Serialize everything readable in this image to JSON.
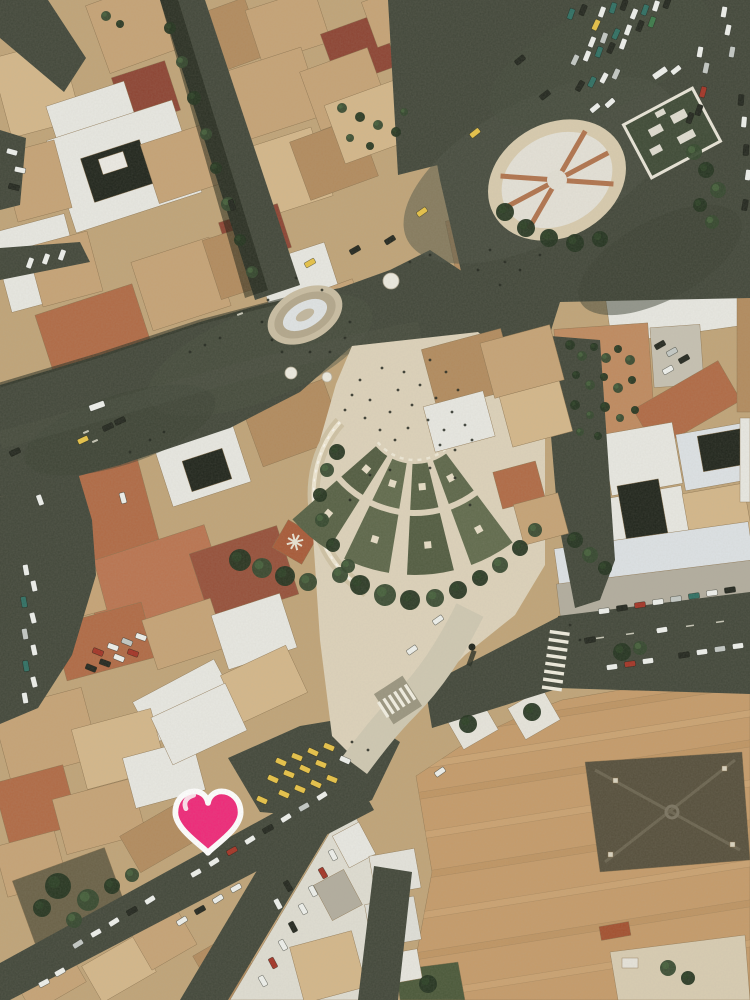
{
  "photo": {
    "description": "Aerial photograph of a Rome city square: dark asphalt boulevard and piazza with parked cars, an oval stone fountain, an oval parterre garden with crossing paths, a cream pedestrian plaza with a fan of terraced green garden beds, terracotta rooftops and a large tan monastery-like roof complex",
    "width": 750,
    "height": 1000
  },
  "marker": {
    "icon": "heart",
    "fill": "#ef2879",
    "stroke": "#ffffff",
    "highlight": "#ffffff",
    "cx": 208,
    "cy": 822
  },
  "palette": {
    "base": "#c0a478",
    "asphalt": "#42473a",
    "asphaltLight": "#4c5244",
    "asphaltDark": "#373c2f",
    "plaza": "#ddd2ba",
    "plazaLight": "#e7ddc6",
    "stone": "#cfc2a4",
    "terrace": "#5d674a",
    "terraceDark": "#525c41",
    "treeDark": "#243420",
    "tree": "#35482e",
    "roofTerracotta": "#b06a45",
    "roofDarkRed": "#8d4433",
    "tan": "#c6a376",
    "white": "#e8e8e2",
    "complex": "#c59b6a",
    "darkRoof": "#564f3c",
    "courtyard": "#20251c",
    "cars": {
      "white": "#eef0ec",
      "silver": "#c3c8c4",
      "dark": "#23271f",
      "red": "#a33426",
      "taxi": "#e7c247",
      "teal": "#2f6f63",
      "green": "#3c7a4a"
    }
  },
  "fan": {
    "cx": 415,
    "cy": 412,
    "bands": [
      [
        52,
        98
      ],
      [
        104,
        163
      ]
    ],
    "angles": [
      50,
      73,
      96,
      119,
      142
    ],
    "gapDeg": 3.2,
    "cellColors": [
      "#5d674a",
      "#576145",
      "#616b4d",
      "#525c41"
    ]
  },
  "cars": [
    [
      571,
      14,
      -70,
      "teal"
    ],
    [
      583,
      10,
      -68,
      "dark"
    ],
    [
      596,
      25,
      -65,
      "taxi"
    ],
    [
      602,
      12,
      -70,
      "white"
    ],
    [
      613,
      8,
      -72,
      "teal"
    ],
    [
      624,
      5,
      -70,
      "dark"
    ],
    [
      634,
      14,
      -68,
      "white"
    ],
    [
      645,
      10,
      -70,
      "teal"
    ],
    [
      656,
      6,
      -72,
      "white"
    ],
    [
      667,
      3,
      -70,
      "dark"
    ],
    [
      592,
      42,
      -68,
      "white"
    ],
    [
      604,
      38,
      -70,
      "silver"
    ],
    [
      616,
      34,
      -66,
      "teal"
    ],
    [
      628,
      30,
      -70,
      "white"
    ],
    [
      640,
      26,
      -68,
      "dark"
    ],
    [
      652,
      22,
      -70,
      "green"
    ],
    [
      575,
      60,
      -65,
      "silver"
    ],
    [
      587,
      56,
      -68,
      "white"
    ],
    [
      599,
      52,
      -70,
      "teal"
    ],
    [
      611,
      48,
      -66,
      "dark"
    ],
    [
      623,
      44,
      -70,
      "white"
    ],
    [
      580,
      86,
      -60,
      "dark"
    ],
    [
      592,
      82,
      -64,
      "teal"
    ],
    [
      604,
      78,
      -62,
      "white"
    ],
    [
      616,
      74,
      -66,
      "silver"
    ],
    [
      660,
      73,
      -35,
      "white",
      1
    ],
    [
      676,
      70,
      -38,
      "white"
    ],
    [
      700,
      52,
      -80,
      "white"
    ],
    [
      706,
      68,
      -78,
      "silver"
    ],
    [
      703,
      92,
      -75,
      "red"
    ],
    [
      699,
      110,
      -72,
      "dark"
    ],
    [
      690,
      118,
      -70,
      "dark"
    ],
    [
      724,
      12,
      -80,
      "white"
    ],
    [
      728,
      30,
      -78,
      "white"
    ],
    [
      732,
      52,
      -80,
      "silver"
    ],
    [
      741,
      100,
      -85,
      "dark"
    ],
    [
      744,
      122,
      -85,
      "white"
    ],
    [
      746,
      150,
      -85,
      "dark"
    ],
    [
      748,
      175,
      -82,
      "white"
    ],
    [
      745,
      205,
      -80,
      "dark"
    ],
    [
      595,
      108,
      -40,
      "white"
    ],
    [
      610,
      103,
      -42,
      "white"
    ],
    [
      545,
      95,
      -38,
      "dark"
    ],
    [
      520,
      60,
      -40,
      "dark"
    ],
    [
      475,
      133,
      -38,
      "taxi"
    ],
    [
      422,
      212,
      -35,
      "taxi"
    ],
    [
      310,
      263,
      -30,
      "taxi"
    ],
    [
      390,
      240,
      -32,
      "dark"
    ],
    [
      355,
      250,
      -30,
      "dark"
    ],
    [
      97,
      406,
      -20,
      "white",
      1
    ],
    [
      83,
      440,
      -25,
      "taxi"
    ],
    [
      108,
      427,
      -25,
      "dark"
    ],
    [
      120,
      421,
      -25,
      "dark"
    ],
    [
      40,
      500,
      70,
      "white"
    ],
    [
      15,
      452,
      -25,
      "dark"
    ],
    [
      123,
      498,
      75,
      "white"
    ],
    [
      26,
      570,
      80,
      "white"
    ],
    [
      34,
      586,
      78,
      "white"
    ],
    [
      24,
      602,
      80,
      "teal"
    ],
    [
      33,
      618,
      76,
      "white"
    ],
    [
      25,
      634,
      80,
      "silver"
    ],
    [
      34,
      650,
      78,
      "white"
    ],
    [
      26,
      666,
      80,
      "teal"
    ],
    [
      34,
      682,
      76,
      "white"
    ],
    [
      25,
      698,
      80,
      "white"
    ],
    [
      98,
      652,
      22,
      "red"
    ],
    [
      113,
      647,
      20,
      "white"
    ],
    [
      127,
      642,
      22,
      "silver"
    ],
    [
      141,
      637,
      20,
      "white"
    ],
    [
      91,
      668,
      22,
      "dark"
    ],
    [
      105,
      663,
      20,
      "dark"
    ],
    [
      119,
      658,
      22,
      "white"
    ],
    [
      133,
      653,
      20,
      "red"
    ],
    [
      281,
      762,
      24,
      "taxi"
    ],
    [
      297,
      757,
      22,
      "taxi"
    ],
    [
      313,
      752,
      25,
      "taxi"
    ],
    [
      329,
      747,
      23,
      "taxi"
    ],
    [
      273,
      779,
      24,
      "taxi"
    ],
    [
      289,
      774,
      22,
      "taxi"
    ],
    [
      305,
      769,
      25,
      "taxi"
    ],
    [
      321,
      764,
      22,
      "taxi"
    ],
    [
      284,
      794,
      24,
      "taxi"
    ],
    [
      300,
      789,
      23,
      "taxi"
    ],
    [
      316,
      784,
      25,
      "taxi"
    ],
    [
      332,
      779,
      22,
      "taxi"
    ],
    [
      345,
      760,
      24,
      "white"
    ],
    [
      262,
      800,
      24,
      "taxi"
    ],
    [
      322,
      796,
      -32,
      "white"
    ],
    [
      304,
      807,
      -30,
      "silver"
    ],
    [
      286,
      818,
      -32,
      "white"
    ],
    [
      268,
      829,
      -30,
      "dark"
    ],
    [
      250,
      840,
      -32,
      "white"
    ],
    [
      232,
      851,
      -30,
      "red"
    ],
    [
      214,
      862,
      -32,
      "white"
    ],
    [
      196,
      873,
      -30,
      "white"
    ],
    [
      150,
      900,
      -32,
      "white"
    ],
    [
      132,
      911,
      -30,
      "dark"
    ],
    [
      114,
      922,
      -32,
      "white"
    ],
    [
      96,
      933,
      -30,
      "white"
    ],
    [
      78,
      944,
      -32,
      "silver"
    ],
    [
      236,
      888,
      -30,
      "white"
    ],
    [
      218,
      899,
      -32,
      "white"
    ],
    [
      200,
      910,
      -30,
      "dark"
    ],
    [
      182,
      921,
      -32,
      "white"
    ],
    [
      60,
      972,
      -30,
      "white"
    ],
    [
      44,
      983,
      -28,
      "white"
    ],
    [
      333,
      855,
      62,
      "white"
    ],
    [
      323,
      873,
      60,
      "red"
    ],
    [
      313,
      891,
      62,
      "white"
    ],
    [
      303,
      909,
      60,
      "white"
    ],
    [
      293,
      927,
      62,
      "dark"
    ],
    [
      283,
      945,
      60,
      "white"
    ],
    [
      273,
      963,
      62,
      "red"
    ],
    [
      263,
      981,
      60,
      "white"
    ],
    [
      288,
      886,
      60,
      "dark"
    ],
    [
      278,
      904,
      62,
      "white"
    ],
    [
      604,
      611,
      -8,
      "white"
    ],
    [
      622,
      608,
      -8,
      "dark"
    ],
    [
      640,
      605,
      -8,
      "red"
    ],
    [
      658,
      602,
      -8,
      "white"
    ],
    [
      676,
      599,
      -8,
      "silver"
    ],
    [
      694,
      596,
      -8,
      "teal"
    ],
    [
      712,
      593,
      -8,
      "white"
    ],
    [
      730,
      590,
      -8,
      "dark"
    ],
    [
      612,
      667,
      -8,
      "white"
    ],
    [
      630,
      664,
      -8,
      "red"
    ],
    [
      648,
      661,
      -8,
      "white"
    ],
    [
      684,
      655,
      -8,
      "dark"
    ],
    [
      702,
      652,
      -8,
      "white"
    ],
    [
      720,
      649,
      -8,
      "silver"
    ],
    [
      738,
      646,
      -8,
      "white"
    ],
    [
      590,
      640,
      -10,
      "dark"
    ],
    [
      662,
      630,
      -9,
      "white"
    ],
    [
      660,
      345,
      -30,
      "dark"
    ],
    [
      672,
      352,
      -30,
      "silver"
    ],
    [
      684,
      359,
      -30,
      "dark"
    ],
    [
      668,
      370,
      -30,
      "white"
    ],
    [
      440,
      772,
      -35,
      "white"
    ],
    [
      412,
      650,
      -35,
      "white"
    ],
    [
      438,
      620,
      -35,
      "white"
    ],
    [
      12,
      152,
      15,
      "white"
    ],
    [
      20,
      170,
      12,
      "white"
    ],
    [
      14,
      187,
      15,
      "dark"
    ],
    [
      30,
      263,
      -70,
      "white"
    ],
    [
      46,
      259,
      -70,
      "white"
    ],
    [
      62,
      255,
      -70,
      "white"
    ],
    [
      232,
      205,
      72,
      "dark"
    ]
  ],
  "trees": [
    [
      170,
      28,
      6,
      0
    ],
    [
      182,
      62,
      6,
      1
    ],
    [
      194,
      98,
      7,
      0
    ],
    [
      206,
      134,
      6,
      1
    ],
    [
      216,
      168,
      6,
      0
    ],
    [
      228,
      204,
      7,
      1
    ],
    [
      240,
      240,
      6,
      0
    ],
    [
      252,
      272,
      6,
      1
    ],
    [
      342,
      108,
      5,
      1
    ],
    [
      360,
      117,
      5,
      0
    ],
    [
      378,
      125,
      5,
      1
    ],
    [
      396,
      132,
      5,
      0
    ],
    [
      350,
      138,
      4,
      1
    ],
    [
      370,
      146,
      4,
      0
    ],
    [
      404,
      112,
      4,
      1
    ],
    [
      694,
      152,
      8,
      1
    ],
    [
      706,
      170,
      8,
      0
    ],
    [
      718,
      190,
      8,
      1
    ],
    [
      700,
      205,
      7,
      0
    ],
    [
      712,
      222,
      7,
      1
    ],
    [
      505,
      212,
      9,
      0
    ],
    [
      526,
      228,
      9,
      0
    ],
    [
      549,
      238,
      9,
      0
    ],
    [
      575,
      243,
      9,
      0
    ],
    [
      600,
      239,
      8,
      0
    ],
    [
      337,
      452,
      8,
      0
    ],
    [
      327,
      470,
      7,
      1
    ],
    [
      320,
      495,
      7,
      0
    ],
    [
      322,
      520,
      7,
      1
    ],
    [
      333,
      545,
      7,
      0
    ],
    [
      348,
      566,
      7,
      1
    ],
    [
      360,
      585,
      10,
      0
    ],
    [
      385,
      595,
      11,
      1
    ],
    [
      410,
      600,
      10,
      0
    ],
    [
      435,
      598,
      9,
      1
    ],
    [
      458,
      590,
      9,
      0
    ],
    [
      340,
      575,
      8,
      1
    ],
    [
      240,
      560,
      11,
      0
    ],
    [
      262,
      568,
      10,
      1
    ],
    [
      285,
      576,
      10,
      0
    ],
    [
      308,
      582,
      9,
      1
    ],
    [
      480,
      578,
      8,
      0
    ],
    [
      500,
      565,
      8,
      1
    ],
    [
      520,
      548,
      8,
      0
    ],
    [
      535,
      530,
      7,
      1
    ],
    [
      575,
      540,
      8,
      0
    ],
    [
      590,
      555,
      8,
      1
    ],
    [
      605,
      568,
      7,
      0
    ],
    [
      570,
      345,
      5,
      0
    ],
    [
      582,
      356,
      5,
      1
    ],
    [
      594,
      347,
      4,
      0
    ],
    [
      606,
      358,
      5,
      1
    ],
    [
      618,
      349,
      4,
      0
    ],
    [
      630,
      360,
      5,
      1
    ],
    [
      576,
      375,
      4,
      0
    ],
    [
      590,
      385,
      5,
      1
    ],
    [
      604,
      377,
      4,
      0
    ],
    [
      618,
      388,
      5,
      1
    ],
    [
      632,
      380,
      4,
      0
    ],
    [
      575,
      405,
      5,
      0
    ],
    [
      590,
      415,
      4,
      1
    ],
    [
      605,
      407,
      5,
      0
    ],
    [
      620,
      418,
      4,
      1
    ],
    [
      635,
      410,
      4,
      0
    ],
    [
      580,
      432,
      4,
      1
    ],
    [
      598,
      436,
      4,
      0
    ],
    [
      58,
      886,
      13,
      0
    ],
    [
      88,
      900,
      11,
      1
    ],
    [
      42,
      908,
      9,
      0
    ],
    [
      74,
      920,
      8,
      1
    ],
    [
      112,
      886,
      8,
      0
    ],
    [
      132,
      875,
      7,
      1
    ],
    [
      622,
      652,
      9,
      0
    ],
    [
      640,
      648,
      7,
      1
    ],
    [
      428,
      984,
      9,
      0
    ],
    [
      668,
      968,
      8,
      1
    ],
    [
      688,
      978,
      7,
      0
    ],
    [
      106,
      16,
      5,
      1
    ],
    [
      120,
      24,
      4,
      0
    ],
    [
      468,
      724,
      9,
      0
    ],
    [
      532,
      712,
      9,
      0
    ]
  ],
  "people": [
    [
      360,
      380
    ],
    [
      370,
      400
    ],
    [
      382,
      368
    ],
    [
      390,
      412
    ],
    [
      398,
      390
    ],
    [
      404,
      372
    ],
    [
      412,
      405
    ],
    [
      420,
      385
    ],
    [
      428,
      420
    ],
    [
      436,
      398
    ],
    [
      444,
      430
    ],
    [
      452,
      412
    ],
    [
      380,
      430
    ],
    [
      395,
      440
    ],
    [
      408,
      428
    ],
    [
      365,
      418
    ],
    [
      430,
      360
    ],
    [
      446,
      372
    ],
    [
      458,
      390
    ],
    [
      465,
      425
    ],
    [
      472,
      440
    ],
    [
      352,
      395
    ],
    [
      345,
      410
    ],
    [
      440,
      445
    ],
    [
      455,
      450
    ],
    [
      268,
      300
    ],
    [
      262,
      322
    ],
    [
      272,
      340
    ],
    [
      282,
      352
    ],
    [
      330,
      352
    ],
    [
      345,
      338
    ],
    [
      350,
      322
    ],
    [
      322,
      290
    ],
    [
      296,
      278
    ],
    [
      310,
      352
    ],
    [
      490,
      250
    ],
    [
      505,
      262
    ],
    [
      520,
      270
    ],
    [
      540,
      255
    ],
    [
      500,
      285
    ],
    [
      478,
      270
    ],
    [
      430,
      255
    ],
    [
      410,
      262
    ],
    [
      205,
      345
    ],
    [
      190,
      352
    ],
    [
      220,
      338
    ],
    [
      164,
      432
    ],
    [
      150,
      440
    ],
    [
      130,
      452
    ],
    [
      370,
      475
    ],
    [
      390,
      470
    ],
    [
      430,
      468
    ],
    [
      455,
      478
    ],
    [
      470,
      505
    ],
    [
      350,
      500
    ],
    [
      570,
      625
    ],
    [
      580,
      640
    ],
    [
      352,
      742
    ],
    [
      368,
      750
    ]
  ],
  "umbrellas": [
    [
      291,
      373,
      6
    ],
    [
      327,
      377,
      5
    ],
    [
      391,
      281,
      8
    ]
  ]
}
